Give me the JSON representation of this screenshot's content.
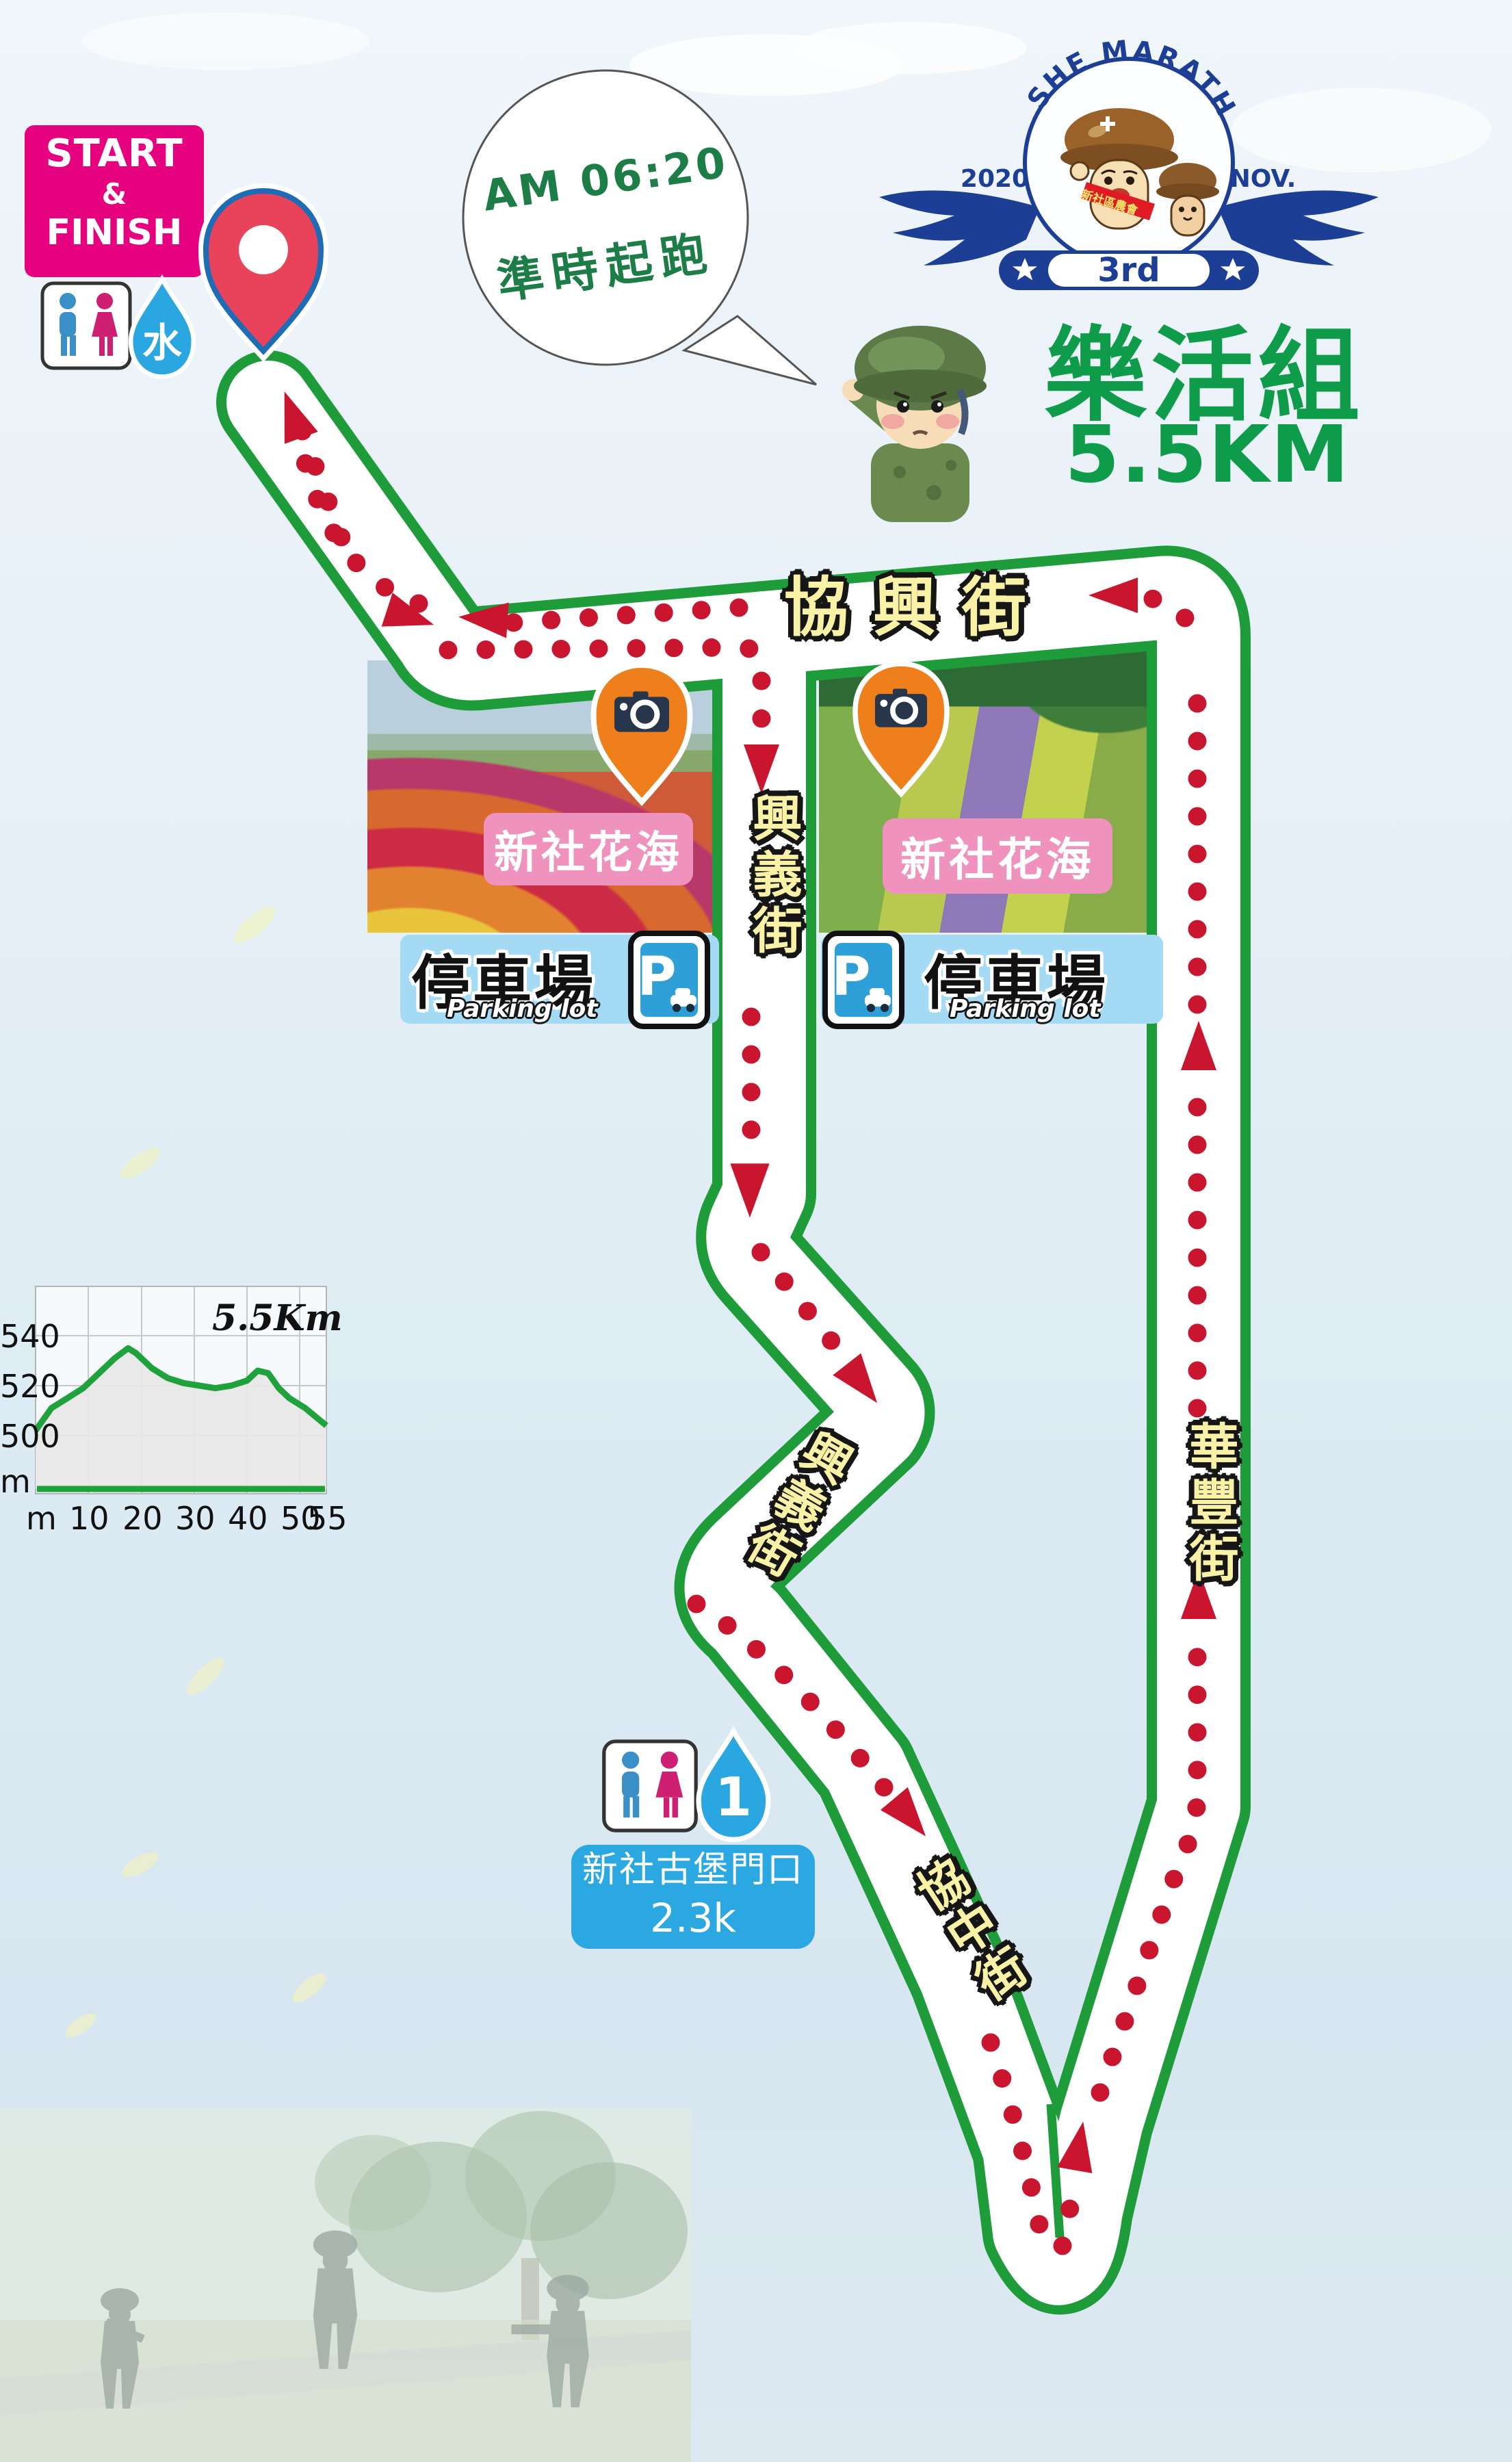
{
  "start_finish": {
    "line1": "START",
    "line2": "&",
    "line3": "FINISH"
  },
  "speech_bubble": {
    "line1": "AM 06:20",
    "line2": "準時起跑"
  },
  "logo": {
    "arc_text": "XINSHE MARATHON",
    "year": "2020",
    "month": "NOV.",
    "edition": "3rd",
    "sash": "新社區農會"
  },
  "event": {
    "group": "樂活組",
    "distance": "5.5KM"
  },
  "streets": {
    "xiexing": "協興街",
    "xingyi_1": "興義街",
    "xingyi_2": "興義街",
    "xiezhong": "協中街",
    "huafeng": "華豐街"
  },
  "photo_spots": [
    {
      "label": "新社花海"
    },
    {
      "label": "新社花海"
    }
  ],
  "parking": {
    "title": "停車場",
    "subtitle": "Parking lot",
    "p": "P"
  },
  "water_station": {
    "number": "1",
    "name": "新社古堡門口",
    "distance": "2.3k"
  },
  "icons": {
    "water_drop_text": "水",
    "star": "★"
  },
  "chart_data": {
    "type": "area",
    "title": "5.5Km",
    "x": [
      0,
      3,
      6,
      9,
      12,
      15,
      17.5,
      19,
      22,
      25,
      28,
      31,
      34,
      37,
      40,
      42,
      44,
      46,
      48,
      51,
      55
    ],
    "elevation_m": [
      502,
      511,
      515,
      519,
      525,
      531,
      535,
      533,
      527,
      523,
      521,
      520,
      519,
      520,
      522,
      526,
      525,
      519,
      515,
      511,
      504
    ],
    "x_ticks": [
      "m",
      "10",
      "20",
      "30",
      "40",
      "50",
      "55"
    ],
    "y_ticks": [
      "540",
      "520",
      "500",
      "m"
    ],
    "xlim": [
      0,
      55
    ],
    "ylim": [
      478,
      560
    ],
    "grid": true,
    "line_color": "#1fa23c",
    "fill_color": "#e7e7e7"
  },
  "colors": {
    "road_green": "#1f9c3a",
    "dot_red": "#c9152e",
    "street_yellow": "#f9f2a6",
    "magenta": "#e6017e",
    "label_pink": "#ef93be",
    "parking_blue": "#a4daf4",
    "sign_blue": "#2f9fd8",
    "water_blue": "#2aa7e0",
    "logo_navy": "#1c3e94",
    "group_green": "#0f9c4a",
    "camera_orange": "#ef7f1b"
  }
}
